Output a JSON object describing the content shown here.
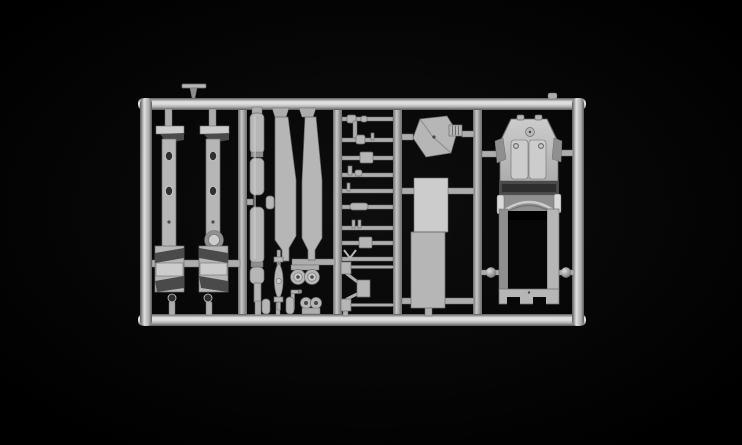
{
  "scene": {
    "description": "Photograph of a light-gray injection-molded plastic model kit sprue (parts tree) for a small armored scout car, lying on a black background",
    "subject": "model-kit-sprue-photo",
    "background": "black",
    "text_visible": "none"
  },
  "colors": {
    "bg": "#000000",
    "vignette": "#0e0e0e",
    "railHi": "#dedede",
    "railMid": "#adadad",
    "railLo": "#595959",
    "runnerHi": "#c8c8c8",
    "runnerLo": "#6b6b6b",
    "part": "#b6b6b6",
    "partLight": "#cccccc",
    "partDark": "#8f8f8f",
    "edge": "#6e6e6e",
    "shadowDark": "#4a4a4a",
    "holeDark": "#303030",
    "visorDark": "#2e2e2e",
    "openingDark": "#070707",
    "bracketLight": "#dadada"
  },
  "parts": [
    {
      "name": "sprue-frame",
      "desc": "rectangular outer runner frame with four inner vertical runners"
    },
    {
      "name": "chassis-rail-left",
      "desc": "long fender/chassis rail with two oval lightening holes and angled mudguard end"
    },
    {
      "name": "chassis-rail-right",
      "desc": "long fender/chassis rail with oval holes, round drum detail and angled mudguard end"
    },
    {
      "name": "exhaust-cylinder",
      "desc": "long segmented cylindrical part (exhaust / barrel sections)"
    },
    {
      "name": "fender-blade-left",
      "desc": "long tapered fender top strip"
    },
    {
      "name": "fender-blade-right",
      "desc": "long tapered fender top strip"
    },
    {
      "name": "axle-rods",
      "desc": "column of nine small axle / linkage rods between two runners"
    },
    {
      "name": "tow-frame",
      "desc": "small open wire frame part with corner blocks"
    },
    {
      "name": "leaf-spring",
      "desc": "lens-shaped leaf spring on a thin rod"
    },
    {
      "name": "wheel-pair-large",
      "desc": "two small road wheels on a stub axle"
    },
    {
      "name": "wheel-pair-small",
      "desc": "two tiny twin wheels on a base"
    },
    {
      "name": "canisters",
      "desc": "two small round-topped cylinders"
    },
    {
      "name": "hexagon-plate",
      "desc": "hexagonal hatch plate"
    },
    {
      "name": "ribbed-block",
      "desc": "small ribbed block beside the hexagon"
    },
    {
      "name": "floor-plate",
      "desc": "long rectangular floor plate in two sections"
    },
    {
      "name": "hull-body",
      "desc": "armored car hull: sloped hood with twin hatches, visor slit, arched detail, open-top fighting compartment"
    },
    {
      "name": "t-shaped-part",
      "desc": "tiny T-shaped part resting on the top rail"
    }
  ]
}
